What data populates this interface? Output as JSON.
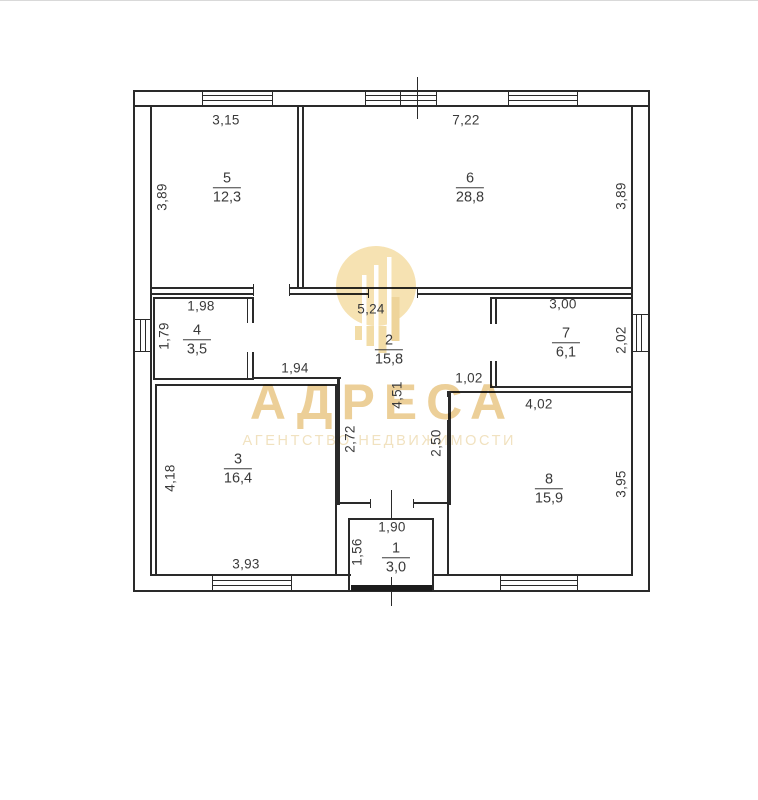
{
  "watermark": {
    "brand": "АДРЕСА",
    "subtitle": "АГЕНТСТВО НЕДВИЖИМОСТИ"
  },
  "colors": {
    "line": "#2a2a2a",
    "text": "#3a3a3a",
    "watermark_gold": "#eccf98",
    "watermark_light": "#f1e2c0",
    "logo_gold": "#f6e2b2"
  },
  "rooms": [
    {
      "id": "5",
      "area": "12,3"
    },
    {
      "id": "6",
      "area": "28,8"
    },
    {
      "id": "4",
      "area": "3,5"
    },
    {
      "id": "2",
      "area": "15,8"
    },
    {
      "id": "7",
      "area": "6,1"
    },
    {
      "id": "3",
      "area": "16,4"
    },
    {
      "id": "8",
      "area": "15,9"
    },
    {
      "id": "1",
      "area": "3,0"
    }
  ],
  "dimensions": {
    "horizontal": [
      {
        "text": "3,15"
      },
      {
        "text": "7,22"
      },
      {
        "text": "1,98"
      },
      {
        "text": "5,24"
      },
      {
        "text": "3,00"
      },
      {
        "text": "1,94"
      },
      {
        "text": "1,02"
      },
      {
        "text": "4,02"
      },
      {
        "text": "1,90"
      },
      {
        "text": "3,93"
      }
    ],
    "vertical": [
      {
        "text": "3,89"
      },
      {
        "text": "3,89"
      },
      {
        "text": "1,79"
      },
      {
        "text": "2,02"
      },
      {
        "text": "4,51"
      },
      {
        "text": "2,72"
      },
      {
        "text": "2,50"
      },
      {
        "text": "4,18"
      },
      {
        "text": "3,95"
      },
      {
        "text": "1,56"
      }
    ]
  }
}
